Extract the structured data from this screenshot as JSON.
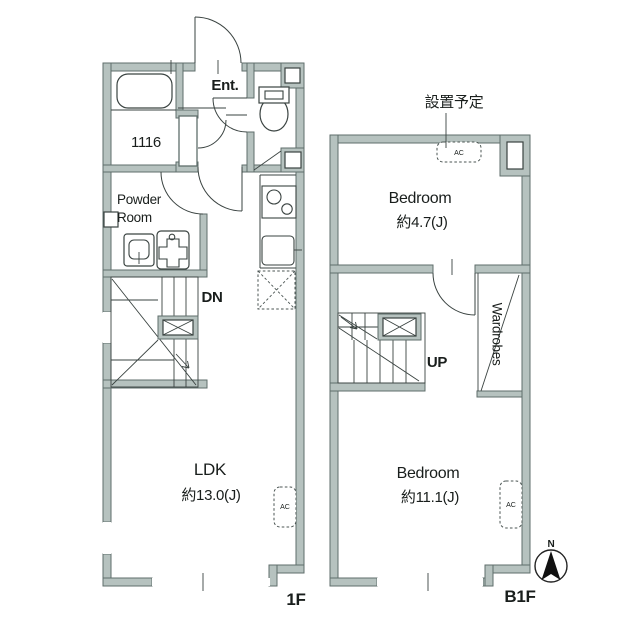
{
  "floorplan": {
    "floor_1f": {
      "label": "1F",
      "entrance": "Ent.",
      "bathroom_model": "1116",
      "powder_room_line1": "Powder",
      "powder_room_line2": "Room",
      "stairs_direction": "DN",
      "ldk_name": "LDK",
      "ldk_size": "約13.0(J)",
      "ac_label": "AC"
    },
    "floor_b1f": {
      "label": "B1F",
      "annotation": "設置予定",
      "bedroom_small_name": "Bedroom",
      "bedroom_small_size": "約4.7(J)",
      "bedroom_large_name": "Bedroom",
      "bedroom_large_size": "約11.1(J)",
      "wardrobes": "Wardrobes",
      "stairs_direction": "UP",
      "ac_label_top": "AC",
      "ac_label_side": "AC"
    },
    "compass": {
      "north": "N"
    },
    "colors": {
      "wall_fill": "#b6c2bf",
      "wall_stroke": "#5f6e6b",
      "line_color": "#3a4341",
      "text_color": "#191e1c"
    }
  }
}
